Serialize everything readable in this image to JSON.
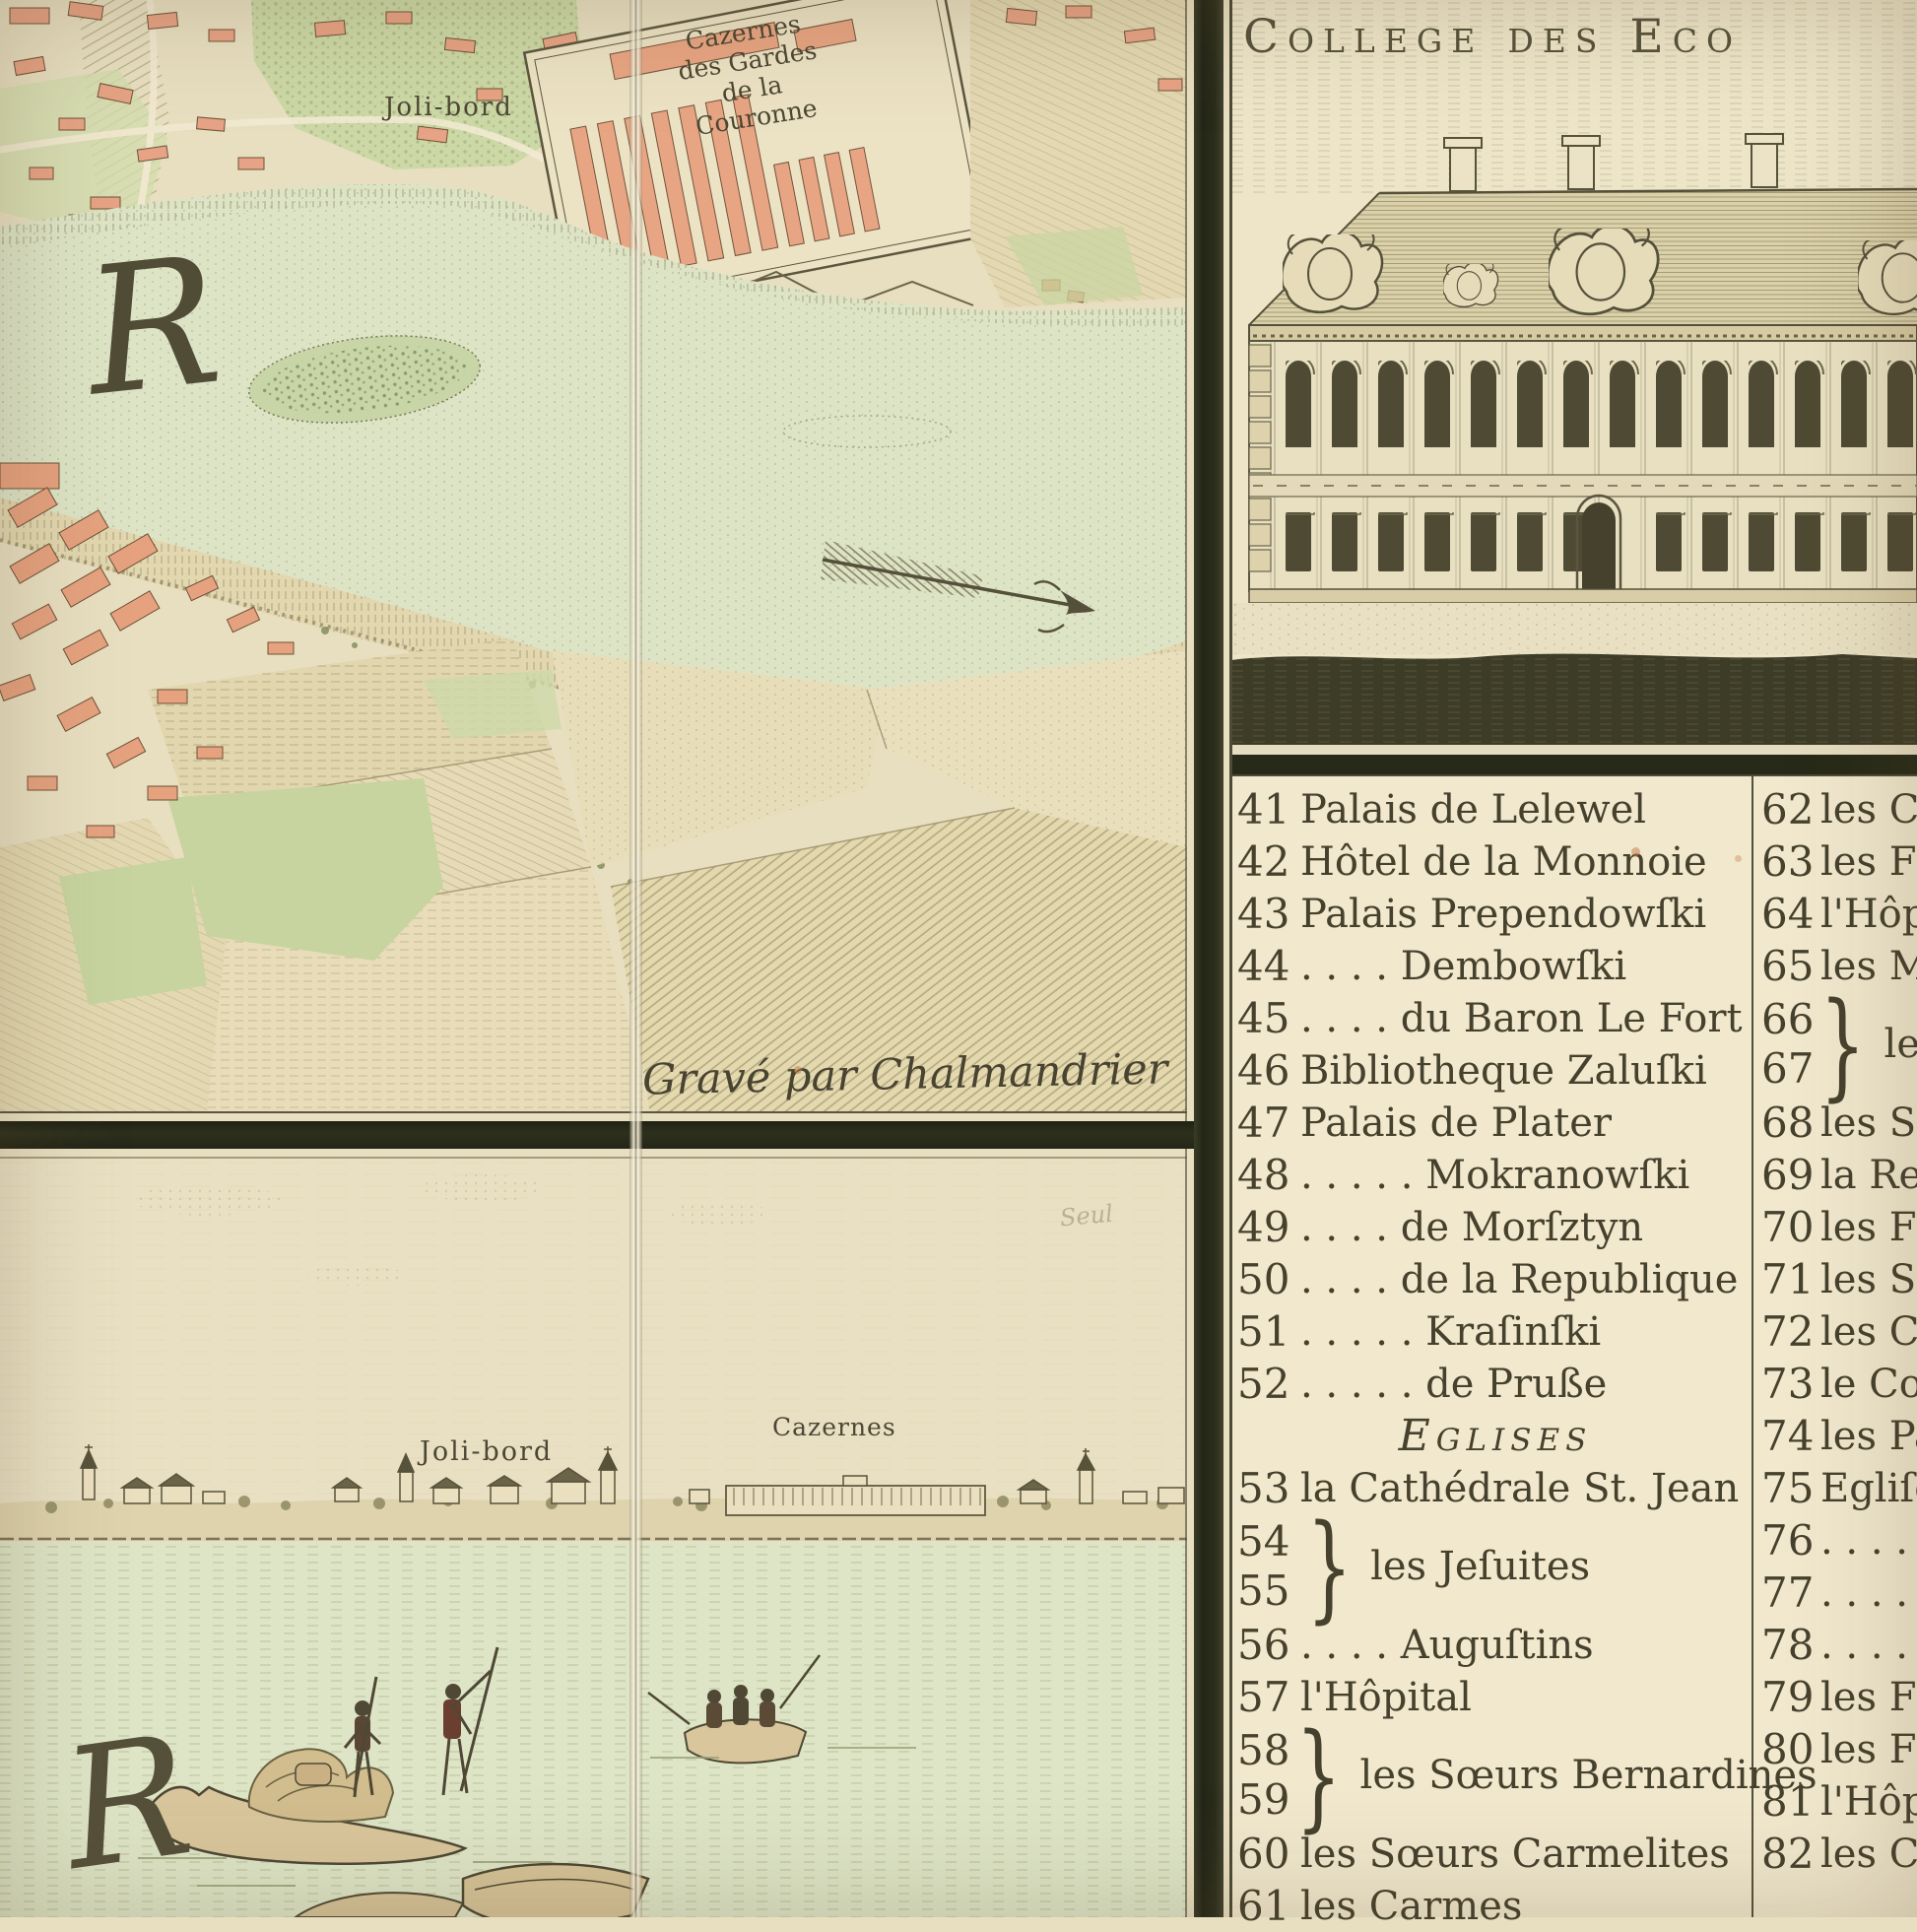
{
  "palette": {
    "paper": "#e9dfc3",
    "legend_paper": "#f1e8ce",
    "water": "#dde4c6",
    "field_green": "#cbd7a5",
    "building_pink": "#e8a583",
    "ink": "#46412d",
    "frame_dark": "#2c2e1c"
  },
  "building_panel": {
    "title": "College des Eco"
  },
  "map_panel": {
    "joli_bord": "Joli-bord",
    "cazernes": [
      "Cazernes",
      "des Gardes",
      "de la",
      "Couronne"
    ],
    "river_letter": "R",
    "engraver_credit": "Gravé par Chalmandrier"
  },
  "panorama_panel": {
    "joli_bord": "Joli-bord",
    "cazernes": "Cazernes",
    "river_letter": "R",
    "pencil_note": "Seul"
  },
  "legend": {
    "brace": "}",
    "heading": "Eglises",
    "left_column": [
      {
        "type": "item",
        "n": "41",
        "t": "Palais de Lelewel"
      },
      {
        "type": "item",
        "n": "42",
        "t": "Hôtel de la Monnoie"
      },
      {
        "type": "item",
        "n": "43",
        "t": "Palais Prependowſki"
      },
      {
        "type": "item",
        "n": "44",
        "t": ". . . .   Dembowſki"
      },
      {
        "type": "item",
        "n": "45",
        "t": ". . . .   du Baron Le Fort"
      },
      {
        "type": "item",
        "n": "46",
        "t": "Bibliotheque Zaluſki"
      },
      {
        "type": "item",
        "n": "47",
        "t": "Palais de Plater"
      },
      {
        "type": "item",
        "n": "48",
        "t": ". . . . .   Mokranowſki"
      },
      {
        "type": "item",
        "n": "49",
        "t": ". . . .   de Morſztyn"
      },
      {
        "type": "item",
        "n": "50",
        "t": ". . . .   de la Republique"
      },
      {
        "type": "item",
        "n": "51",
        "t": ". . . . .  Kraſinſki"
      },
      {
        "type": "item",
        "n": "52",
        "t": ". . . . .  de Pruße"
      },
      {
        "type": "heading",
        "t": "Eglises"
      },
      {
        "type": "item",
        "n": "53",
        "t": "la Cathédrale St. Jean"
      },
      {
        "type": "brace",
        "n1": "54",
        "n2": "55",
        "t": "les Jeſuites"
      },
      {
        "type": "item",
        "n": "56",
        "t": ". . . .   Auguſtins"
      },
      {
        "type": "item",
        "n": "57",
        "t": "l'Hôpital"
      },
      {
        "type": "brace",
        "n1": "58",
        "n2": "59",
        "t": "les Sœurs Bernardines"
      },
      {
        "type": "item",
        "n": "60",
        "t": "les Sœurs Carmelites"
      },
      {
        "type": "item",
        "n": "61",
        "t": "les Carmes"
      }
    ],
    "right_column": [
      {
        "type": "item",
        "n": "62",
        "t": "les C"
      },
      {
        "type": "item",
        "n": "63",
        "t": "les Fi"
      },
      {
        "type": "item",
        "n": "64",
        "t": "l'Hôpi"
      },
      {
        "type": "item",
        "n": "65",
        "t": "les M"
      },
      {
        "type": "brace",
        "n1": "66",
        "n2": "67",
        "t": "les F"
      },
      {
        "type": "item",
        "n": "68",
        "t": "les So"
      },
      {
        "type": "item",
        "n": "69",
        "t": "la Re"
      },
      {
        "type": "item",
        "n": "70",
        "t": "les F"
      },
      {
        "type": "item",
        "n": "71",
        "t": "les So"
      },
      {
        "type": "item",
        "n": "72",
        "t": "les Ca"
      },
      {
        "type": "item",
        "n": "73",
        "t": "le Co"
      },
      {
        "type": "item",
        "n": "74",
        "t": "les Pa"
      },
      {
        "type": "item",
        "n": "75",
        "t": "Egliſe"
      },
      {
        "type": "item",
        "n": "76",
        "t": ". . . ."
      },
      {
        "type": "item",
        "n": "77",
        "t": ". . . ."
      },
      {
        "type": "item",
        "n": "78",
        "t": ". . . ."
      },
      {
        "type": "item",
        "n": "79",
        "t": "les Fr"
      },
      {
        "type": "item",
        "n": "80",
        "t": "les Fr"
      },
      {
        "type": "item",
        "n": "81",
        "t": "l'Hôpit"
      },
      {
        "type": "item",
        "n": "82",
        "t": "les C"
      }
    ]
  }
}
